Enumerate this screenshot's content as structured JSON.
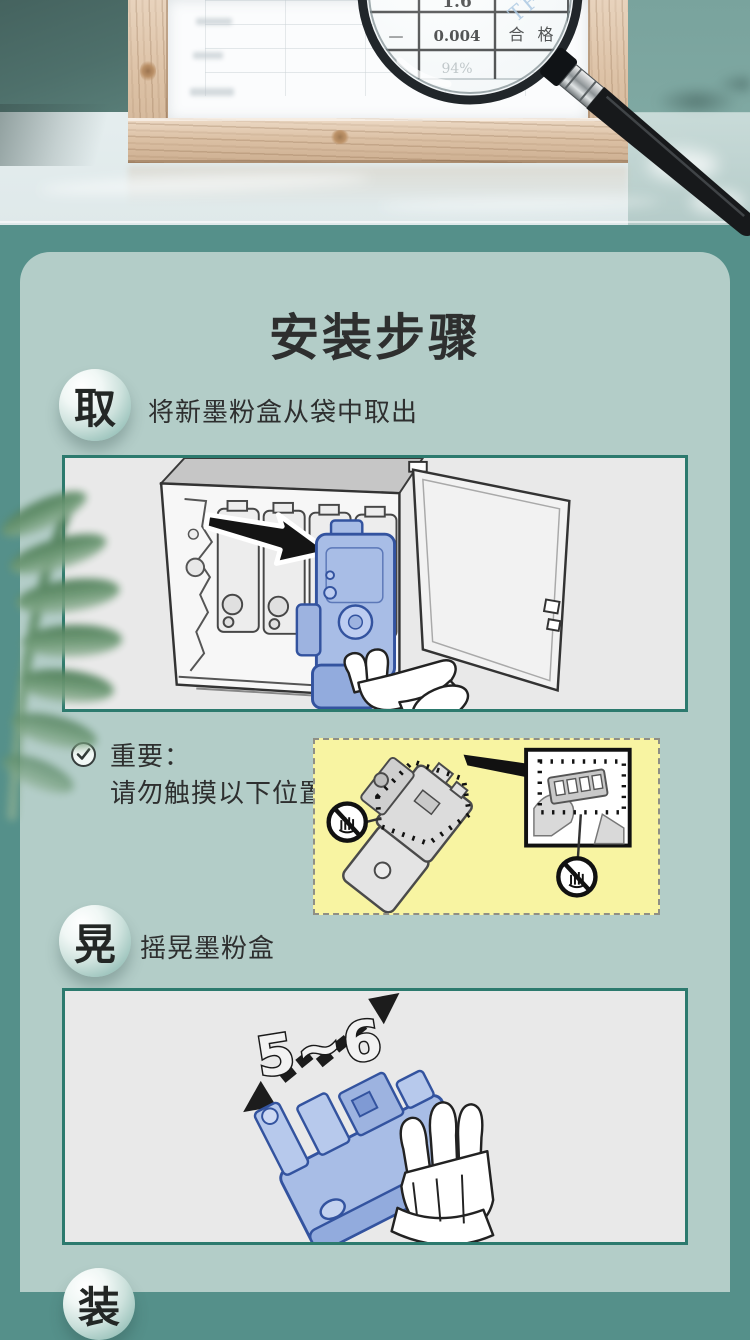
{
  "report": {
    "watermark": "TFIC",
    "lens": {
      "r1c2": "1.6",
      "r2c1": "—",
      "r2c2": "0.004",
      "r2c3": "合 格",
      "r3c2": "94%"
    }
  },
  "install": {
    "title": "安装步骤",
    "steps": [
      {
        "badge": "取",
        "label": "将新墨粉盒从袋中取出"
      },
      {
        "badge": "晃",
        "label": "摇晃墨粉盒"
      },
      {
        "badge": "装",
        "label": ""
      }
    ],
    "important_title": "重要：",
    "important_text": "请勿触摸以下位置",
    "shake_count": "5~6"
  },
  "colors": {
    "page_teal": "#55908a",
    "card_bg": "#b3cdc8",
    "panel_yellow": "#f8f4a2",
    "illustration_border": "#2c7a6e",
    "cartridge_blue": "#a8bde6"
  }
}
